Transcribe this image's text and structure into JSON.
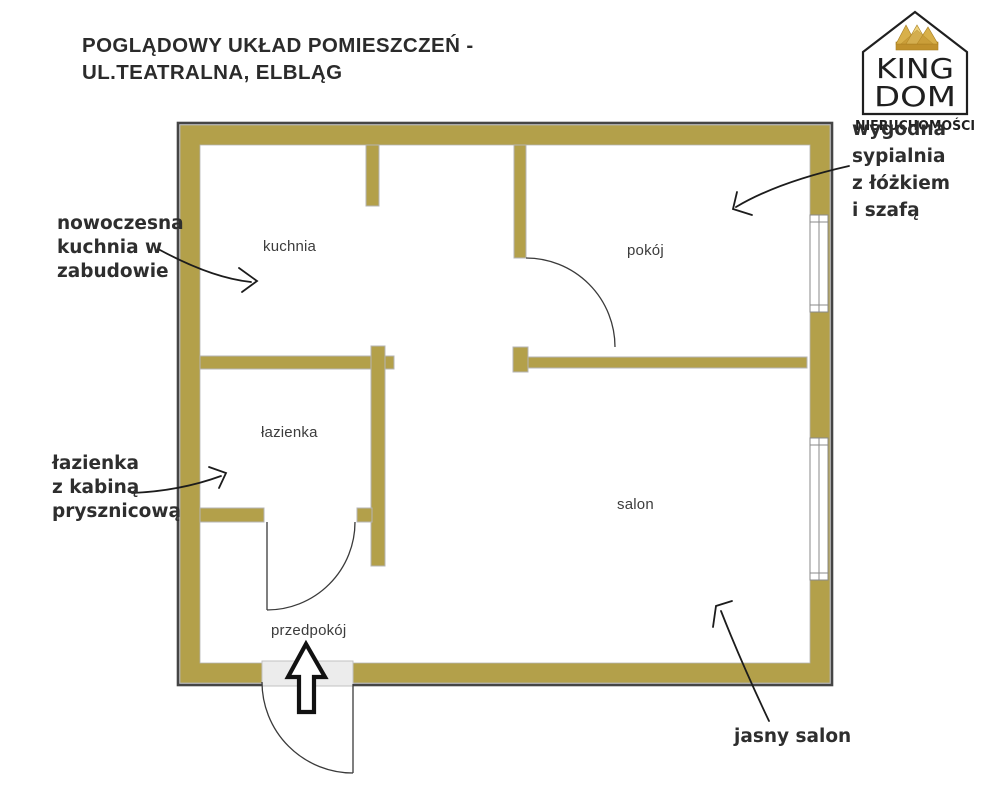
{
  "header": {
    "title": "POGLĄDOWY UKŁAD POMIESZCZEŃ -\nUL.TEATRALNA, ELBLĄG"
  },
  "logo": {
    "brand_line1": "KING",
    "brand_line2": "DOM",
    "tagline": "NIERUCHOMOŚCI"
  },
  "rooms": {
    "kitchen": "kuchnia",
    "bedroom": "pokój",
    "bathroom": "łazienka",
    "living_room": "salon",
    "hallway": "przedpokój"
  },
  "annotations": {
    "kitchen": "nowoczesna\nkuchnia w\nzabudowie",
    "bathroom": "łazienka\nz kabiną\nprysznicową",
    "bedroom": "wygodna\nsypialnia\nz łóżkiem\ni szafą",
    "living_room": "jasny salon"
  },
  "colors": {
    "wall": "#b3a04a",
    "wall_stroke": "#b4b4b4",
    "outline": "#454545",
    "door": "#3a3a3a",
    "window_stroke": "#8a8a8a",
    "threshold": "#ececec",
    "threshold_stroke": "#c2c2c2",
    "arrow": "#1c1c1c",
    "ink": "#1f1f1f",
    "crown_dark": "#c0912c",
    "crown_mid": "#d8b04a",
    "crown_light": "#eed27b",
    "title_ink": "#2b2b2b",
    "label_ink": "#3c3c3c"
  }
}
